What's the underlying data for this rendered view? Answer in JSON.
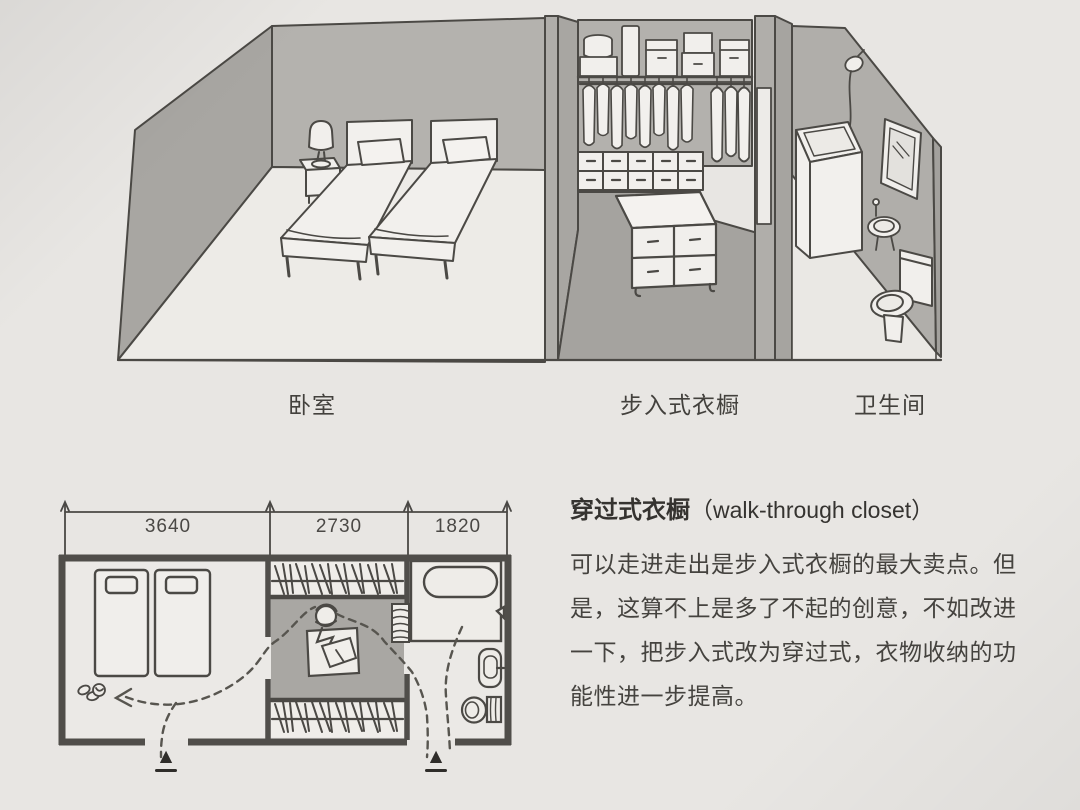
{
  "illustration": {
    "room_labels": [
      {
        "id": "bedroom",
        "label": "卧室"
      },
      {
        "id": "walk_in_closet",
        "label": "步入式衣橱"
      },
      {
        "id": "bathroom",
        "label": "卫生间"
      }
    ]
  },
  "floor_plan": {
    "dimensions": [
      "3640",
      "2730",
      "1820"
    ],
    "entry_marker": "▲"
  },
  "article": {
    "title_zh": "穿过式衣橱",
    "title_en": "（walk-through closet）",
    "body_lines": [
      "可以走进走出是步入式衣橱的最大卖点。但",
      "是，这算不上是多了不起的创意，不如改进",
      "一下，把步入式改为穿过式，衣物收纳的功",
      "能性进一步提高。"
    ]
  },
  "icons": {
    "entry_marker_icon": "▲"
  },
  "colors": {
    "page_background": "#e8e6e3",
    "wall_gray": "#b4b2ae",
    "wall_gray_dark": "#a8a6a2",
    "closet_floor_gray": "#a5a39f",
    "plan_gray": "#a9a7a3",
    "line_color": "#4b4945",
    "text_color": "#45433f"
  }
}
